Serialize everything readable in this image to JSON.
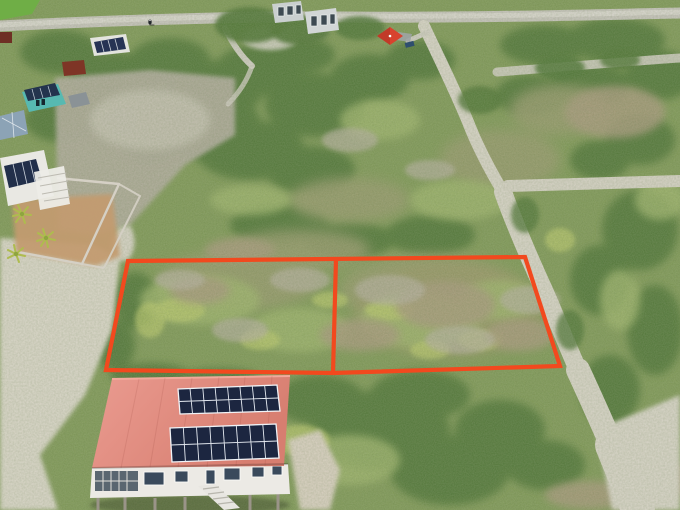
{
  "meta": {
    "type": "aerial-drone-photograph",
    "description": "Drone view of two adjacent vacant scrubland parcels outlined in bright orange, next to a salmon-roofed house with rooftop solar arrays; sandy dirt roads cross the green coastal scrub, with a small neighborhood cluster and a paved road at the upper left."
  },
  "palette": {
    "boundary_orange": "#F2491E",
    "veg_base": "#7E9756",
    "veg_dark": "#4E7334",
    "veg_light": "#9DB36A",
    "veg_accent": "#B9C86A",
    "olive_scrub": "#96996C",
    "dry_brush": "#A6987A",
    "twig_grey": "#B5AF9F",
    "sand": "#D9D5C8",
    "rock": "#AFAA9B",
    "road_paved": "#C6C3BC",
    "road_sand": "#D7D3C7",
    "roof_salmon": "#E18C80",
    "solar_panel": "#1C2640",
    "wall_white": "#ECEAE5",
    "teal_house": "#57B9B1",
    "gazebo_red": "#D8432E",
    "shed_red": "#7E3526",
    "yard_tan": "#C29B6F",
    "blue_roof": "#8CA3B6",
    "lawn_green": "#6FAE46"
  },
  "plot_boundary": {
    "color": "#F2491E",
    "stroke_width": 4.2,
    "outer_points": "128,261 525,257 560,366 333,373 106,370",
    "divider": {
      "x1": 336,
      "y1": 259,
      "x2": 333,
      "y2": 373
    }
  },
  "scene": {
    "landmarks": [
      {
        "name": "outlined-land-plots",
        "detail": "two adjacent rectangular parcels marked by an orange boundary with a central divider"
      },
      {
        "name": "solar-house",
        "detail": "salmon/terracotta roofed house with two 16-panel solar arrays, white walls, louvered porch, staircase and stilts"
      },
      {
        "name": "dirt-road-main",
        "detail": "winding sandy dirt road along the right side of the plots with side branches"
      },
      {
        "name": "paved-road",
        "detail": "grey paved road across the top edge carrying a motorbike rider"
      },
      {
        "name": "neighborhood-cluster",
        "detail": "teal cottage with solar roof, white cabins, dark-red shed, walled tan yard, palms at upper left"
      },
      {
        "name": "red-gazebo",
        "detail": "small red pyramid-roof structure at top center"
      },
      {
        "name": "terrain",
        "detail": "low green coastal scrub with white limestone sand clearings"
      }
    ]
  }
}
